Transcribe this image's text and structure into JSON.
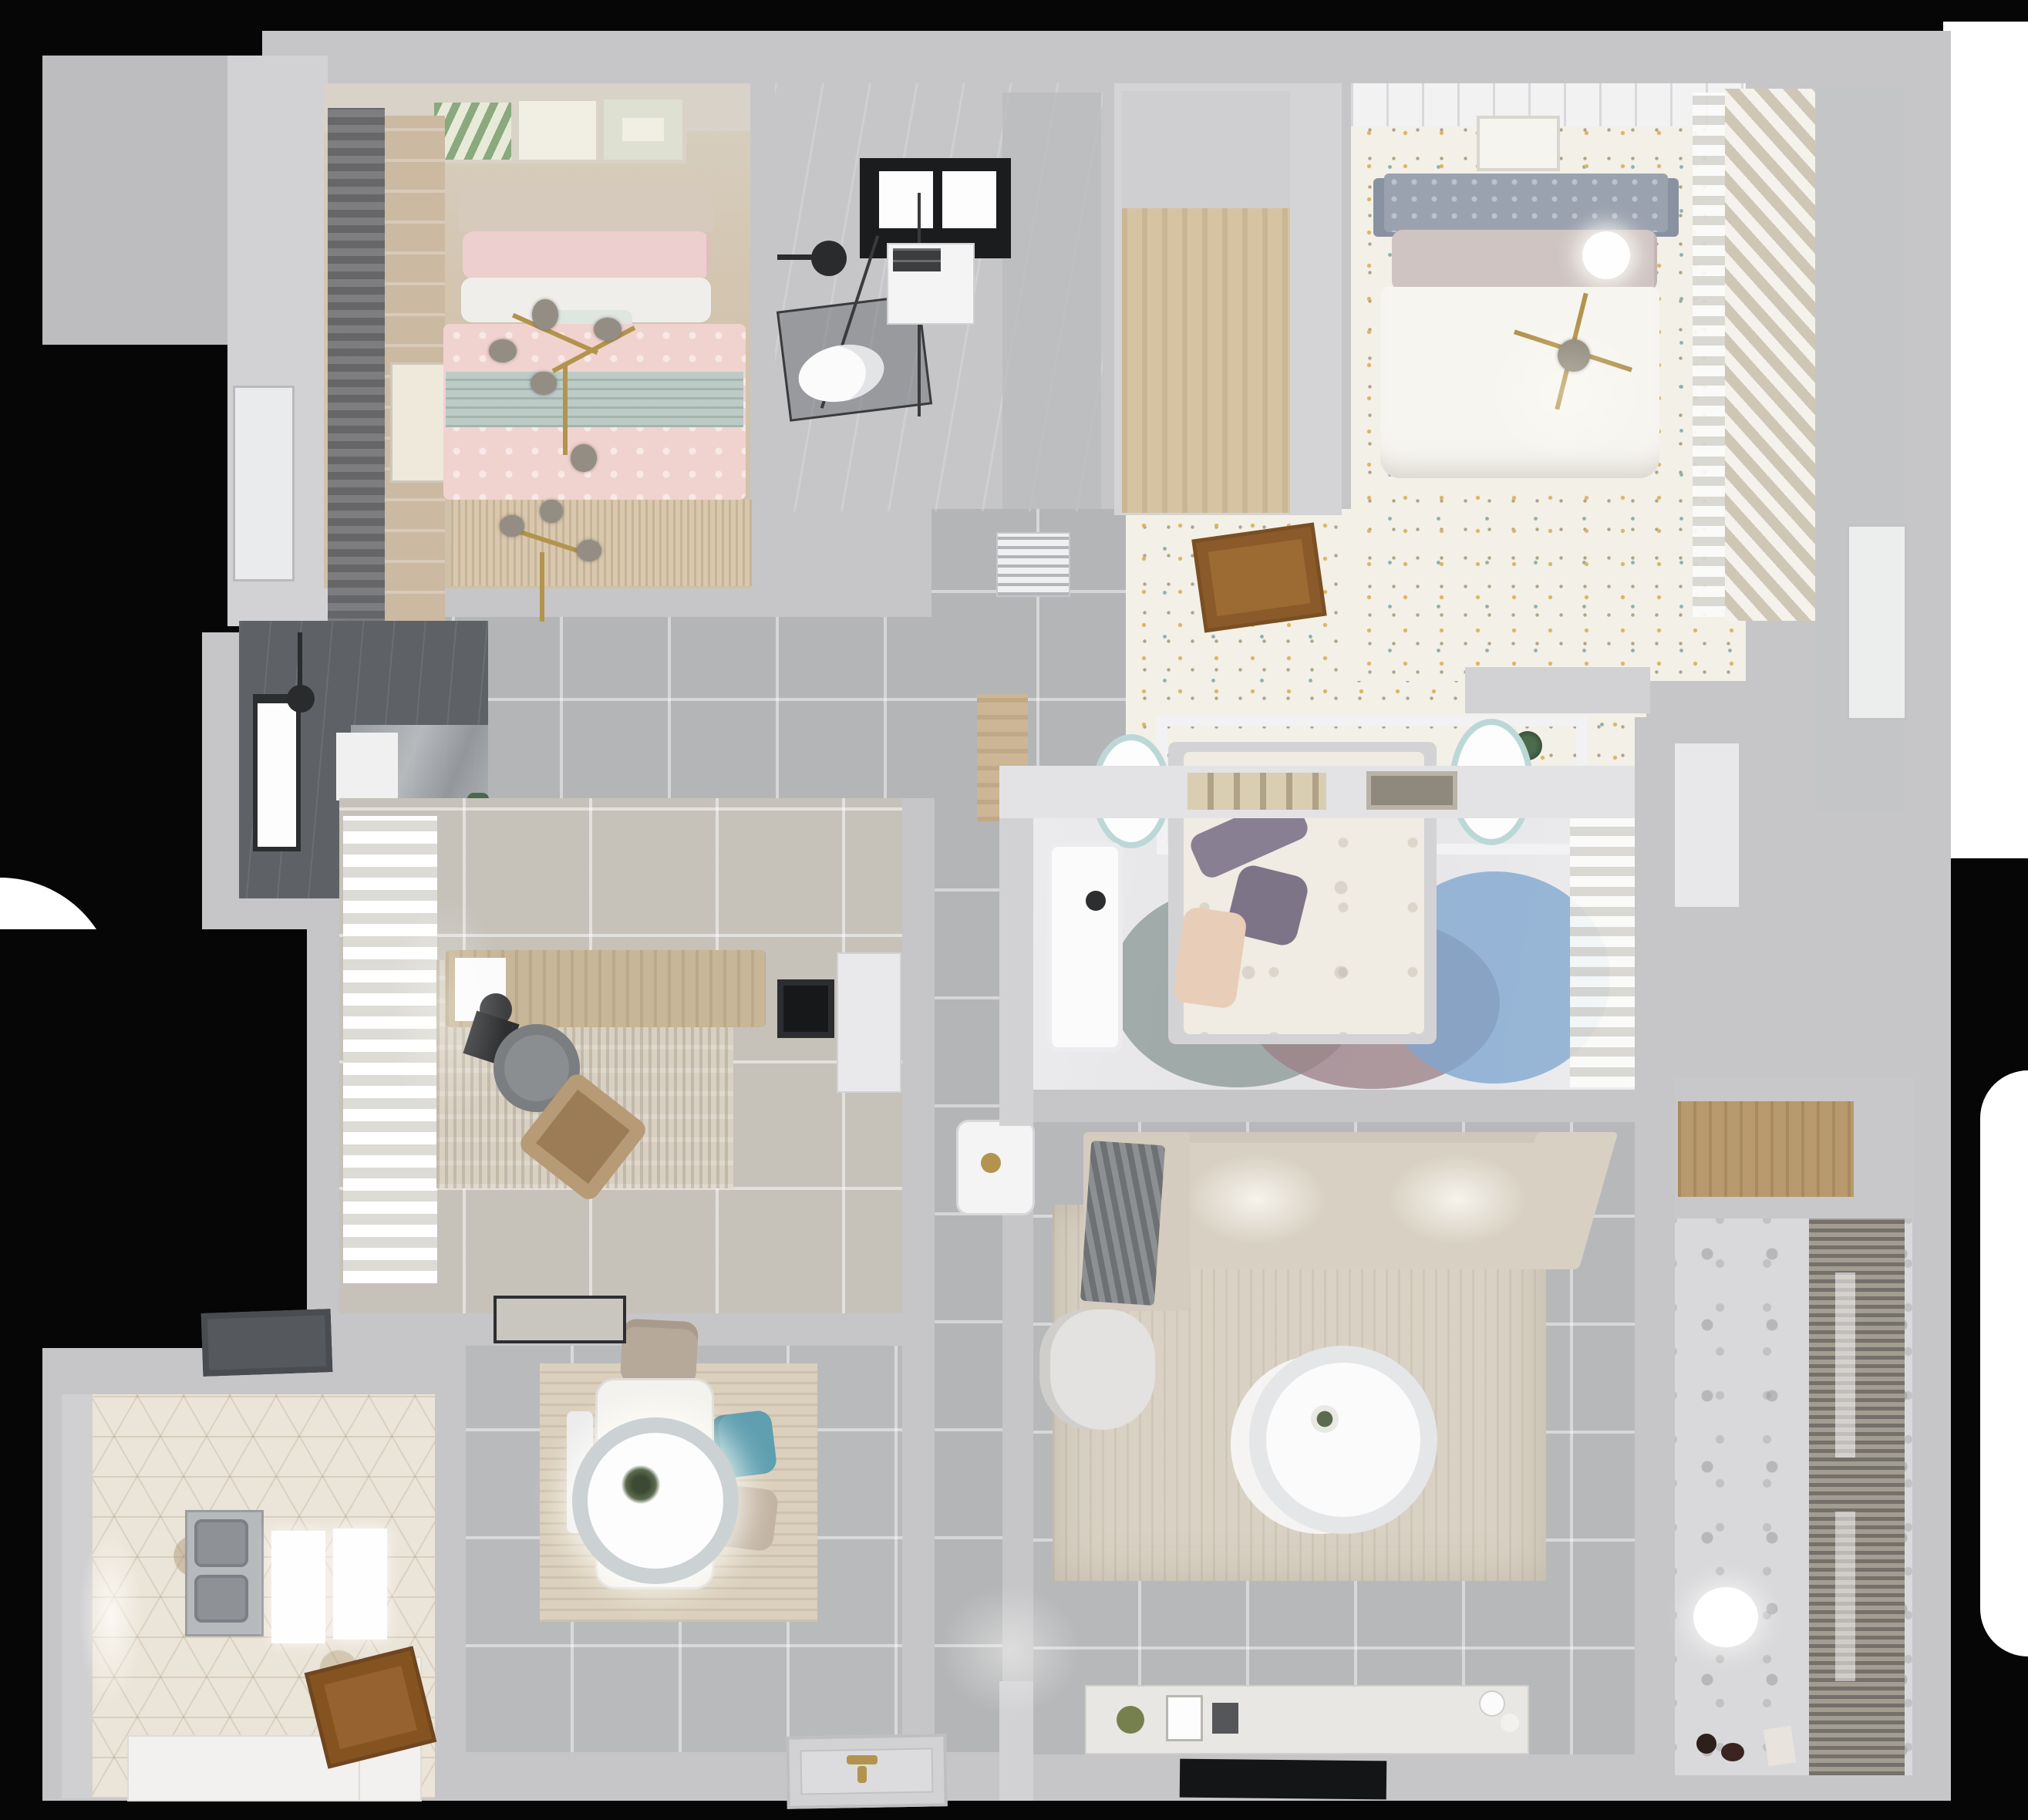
{
  "scene": {
    "description": "Top-down 3D rendered floor plan of an apartment",
    "background_color": "#060606",
    "outside_patches": [
      "white-top-right",
      "white-right-edge",
      "white-left-edge"
    ]
  },
  "palette": {
    "wall": "#c6c6c9",
    "hall_tile": "#b4b5b7",
    "bedroom1_floor_wood": "#d3c5b0",
    "bedroom2_floor_speckled": "#f3f0e7",
    "bedroom3_floor": "#e9e9ea",
    "living_tile": "#b7b8ba",
    "kitchen_hex_tile": "#ebe4d8",
    "dining_wood": "#dbd0bd",
    "shower_room_dark": "#5e6266",
    "bath2_pattern": "#d9d9db",
    "accent_pink": "#f0d3cf",
    "accent_teal_blanket": "#bccbc6",
    "accent_teal_chair": "#5e9fb0",
    "accent_blue_rug": "#7fa7cf",
    "accent_mauve_rug": "#9b8288",
    "accent_gold": "#b3944e",
    "door_wood": "#96622f"
  },
  "rooms": [
    {
      "id": "bedroom-pink",
      "label": "Bedroom 1 (pink)",
      "furniture": [
        "double-bed-pink",
        "headboard",
        "pillows",
        "teal-runner-blanket",
        "branch-chandelier",
        "wall-art-frames-3",
        "dark-curtain",
        "side-picture",
        "fringe-rug"
      ]
    },
    {
      "id": "bathroom-top",
      "label": "Bathroom with skylight",
      "furniture": [
        "skylight-window",
        "rain-shower-head",
        "glass-shower-enclosure",
        "vanity-cabinet",
        "toilet"
      ]
    },
    {
      "id": "storage-room",
      "label": "Walk-in storage / cloakroom",
      "furniture": [
        "wood-floor-area"
      ]
    },
    {
      "id": "bedroom-white",
      "label": "Bedroom 2 (white, speckled floor)",
      "furniture": [
        "double-bed-white",
        "gray-headboard",
        "cross-chandelier",
        "art-frame",
        "slatted-wardrobe",
        "sheer-curtain",
        "disc-lamp"
      ]
    },
    {
      "id": "corridor-top",
      "label": "Bedroom corridor",
      "furniture": [
        "open-wood-door",
        "ac-vent",
        "plant",
        "wood-threshold"
      ]
    },
    {
      "id": "bedroom-middle",
      "label": "Bedroom 3 (canopy bed)",
      "furniture": [
        "canopy-frame",
        "bed-floral-duvet",
        "purple-pillows",
        "peach-pillow",
        "round-rugs-3",
        "nightstand-lamps-2",
        "white-desk",
        "book-shelf",
        "sheer-curtain"
      ]
    },
    {
      "id": "living-room",
      "label": "Living room",
      "furniture": [
        "beige-sofa",
        "gray-throw-blanket",
        "area-rug",
        "round-coffee-table",
        "armchair",
        "side-stool",
        "tv-console",
        "tv-panel",
        "decor-items"
      ]
    },
    {
      "id": "dining-area",
      "label": "Dining area",
      "furniture": [
        "dining-table",
        "pendant-lamp",
        "teal-chair",
        "beige-chairs-2",
        "bench",
        "wood-floor-rug"
      ]
    },
    {
      "id": "kitchen",
      "label": "Kitchen",
      "furniture": [
        "double-sink",
        "range-hood",
        "white-counters",
        "white-panels-2",
        "wood-door",
        "window"
      ]
    },
    {
      "id": "shower-room",
      "label": "Dark shower room",
      "furniture": [
        "shower-head",
        "window",
        "shelf",
        "toilet",
        "plant"
      ]
    },
    {
      "id": "study",
      "label": "Study / office",
      "furniture": [
        "desk",
        "desk-chair",
        "lounge-chair",
        "laptop",
        "monitor",
        "rug",
        "curtains",
        "doormat",
        "side-cabinet"
      ]
    },
    {
      "id": "bathroom-bottom-right",
      "label": "Laundry / bathroom with blinds",
      "furniture": [
        "roller-blinds",
        "ceiling-light",
        "wood-counter",
        "floor-toys"
      ]
    },
    {
      "id": "hallway",
      "label": "Hallway",
      "furniture": [
        "entry-door-mat"
      ]
    },
    {
      "id": "balcony-corridor",
      "label": "Right corridor / balcony",
      "furniture": [
        "white-door"
      ]
    }
  ]
}
